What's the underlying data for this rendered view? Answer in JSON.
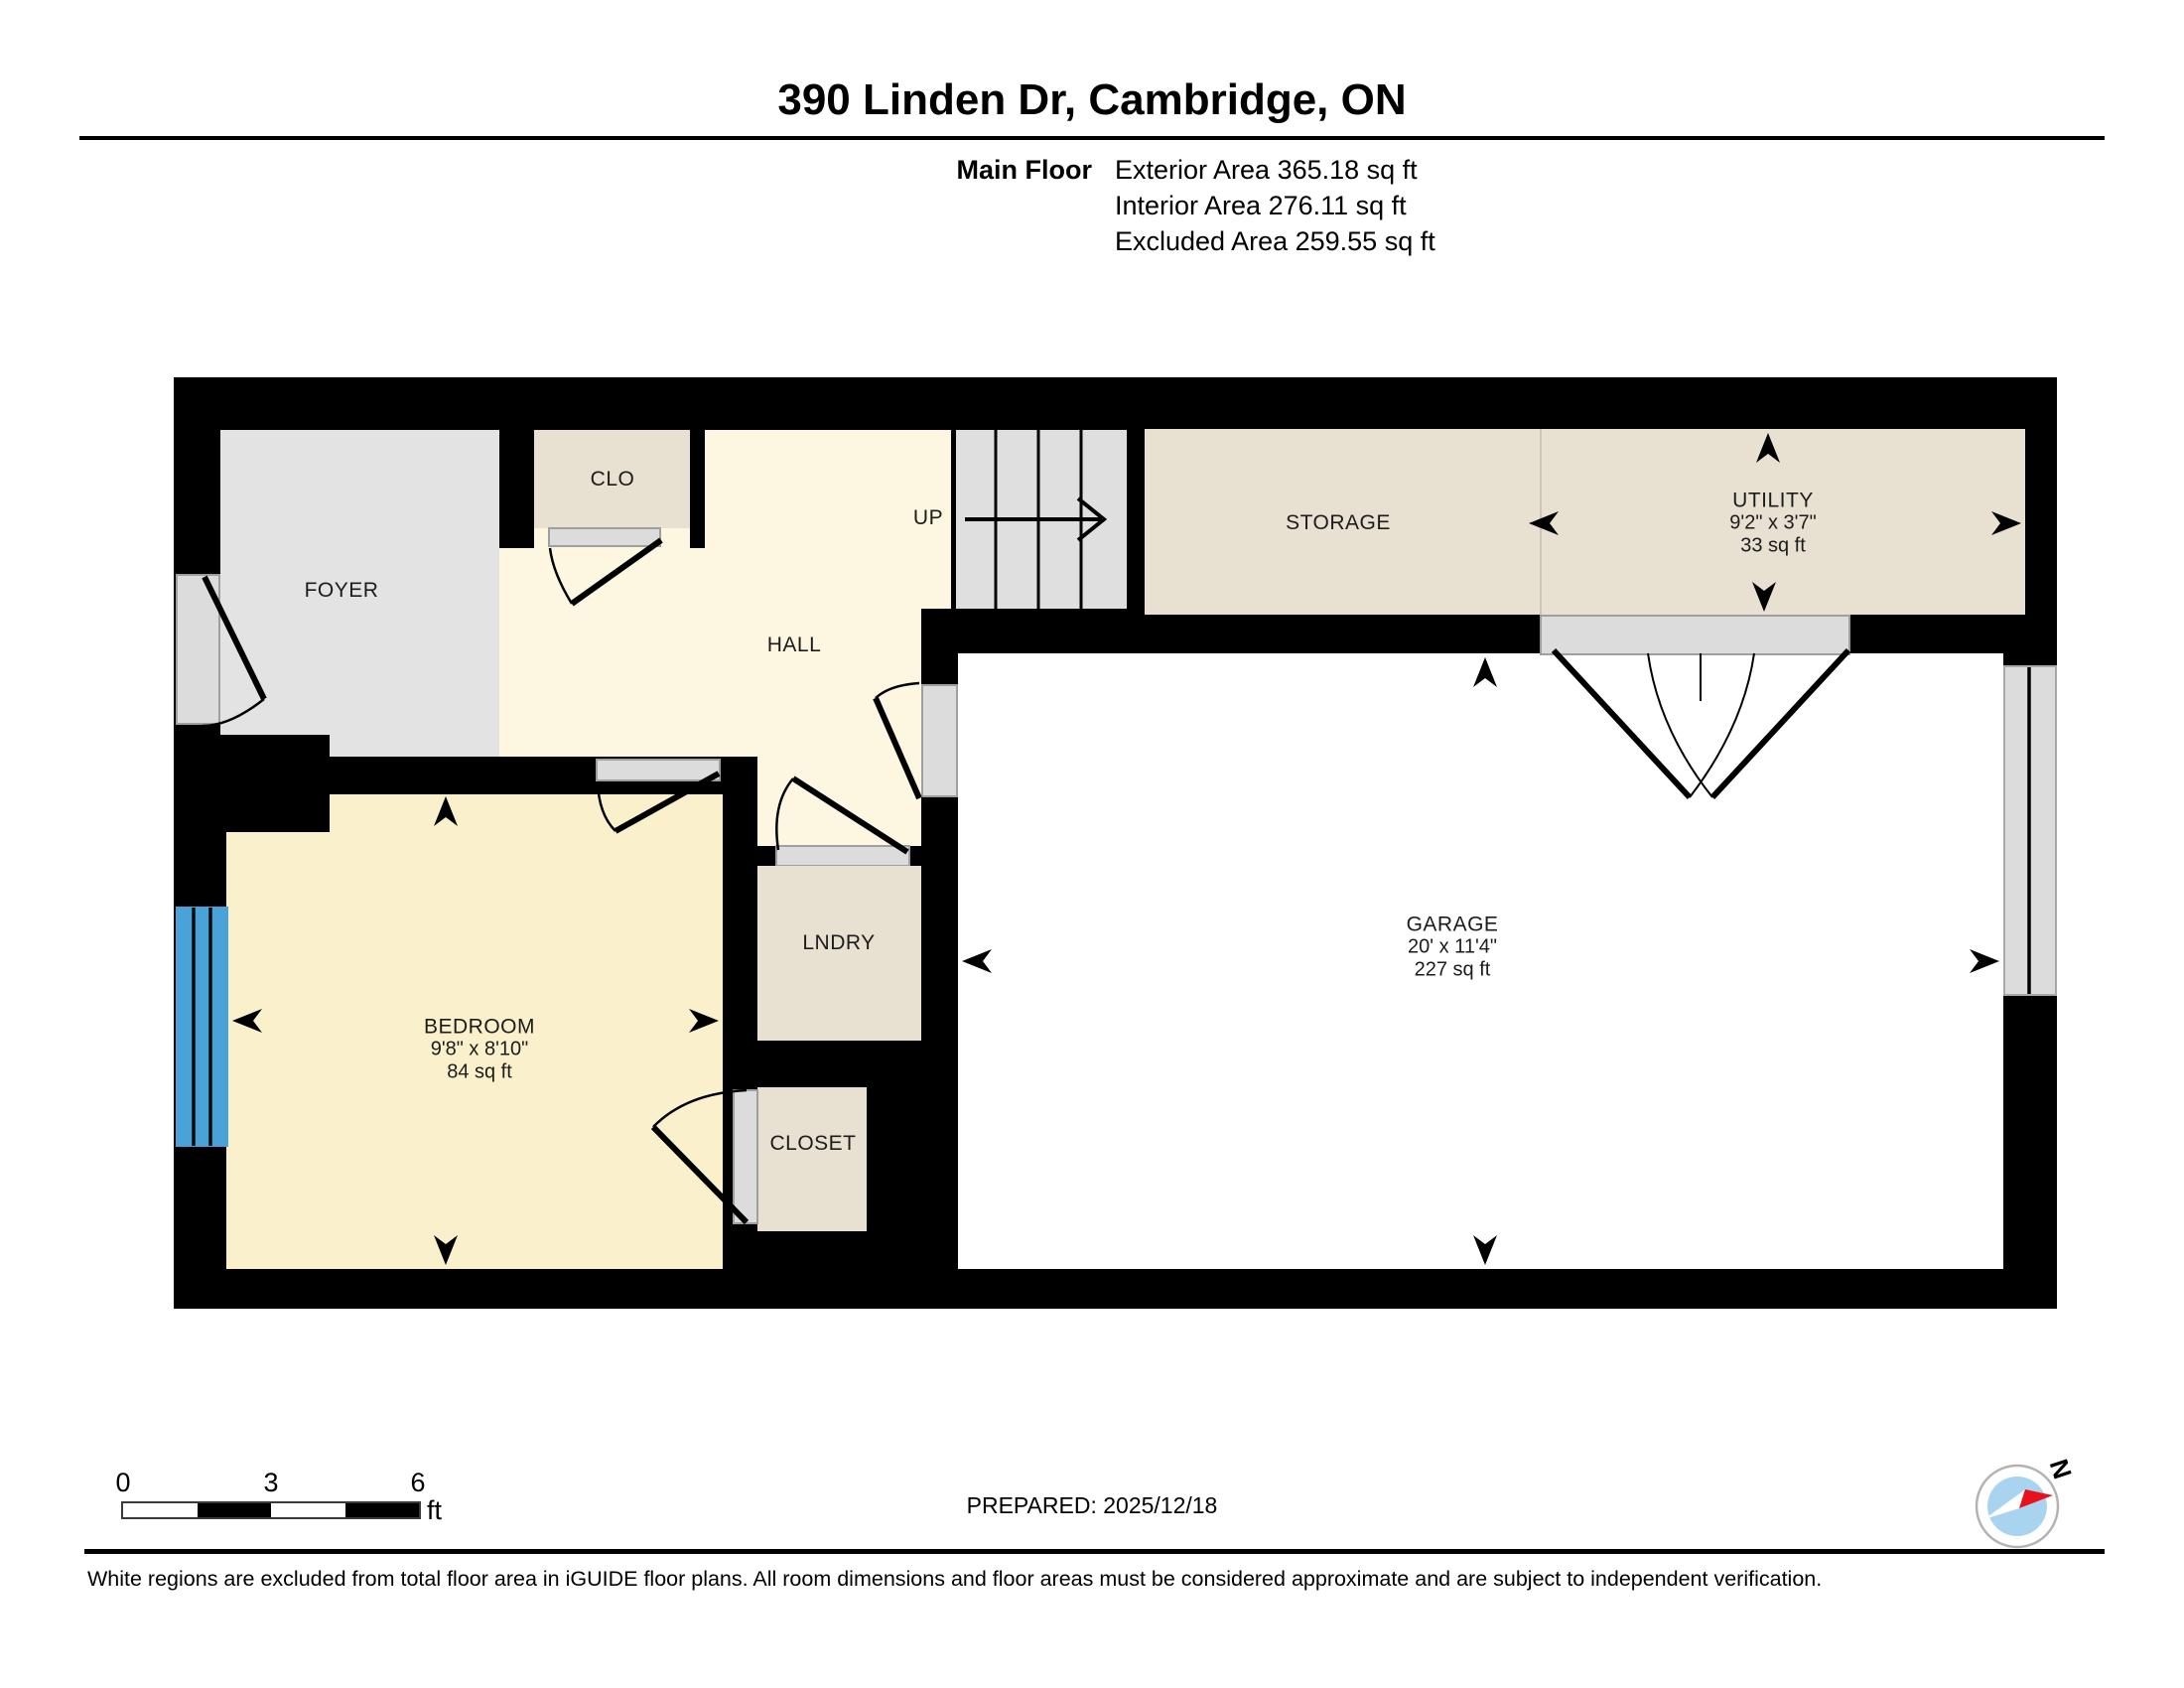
{
  "header": {
    "title": "390 Linden Dr, Cambridge, ON",
    "floor_label": "Main Floor",
    "stats": [
      "Exterior Area 365.18 sq ft",
      "Interior Area 276.11 sq ft",
      "Excluded Area 259.55 sq ft"
    ]
  },
  "rooms": {
    "foyer": {
      "label": "FOYER"
    },
    "clo": {
      "label": "CLO"
    },
    "hall": {
      "label": "HALL"
    },
    "stairs": {
      "label": "UP"
    },
    "storage": {
      "label": "STORAGE"
    },
    "utility": {
      "label": "UTILITY",
      "dimensions": "9'2\" x 3'7\"",
      "area": "33 sq ft"
    },
    "bedroom": {
      "label": "BEDROOM",
      "dimensions": "9'8\" x 8'10\"",
      "area": "84 sq ft"
    },
    "lndry": {
      "label": "LNDRY"
    },
    "closet": {
      "label": "CLOSET"
    },
    "garage": {
      "label": "GARAGE",
      "dimensions": "20' x 11'4\"",
      "area": "227 sq ft"
    }
  },
  "scale_bar": {
    "ticks": [
      "0",
      "3",
      "6"
    ],
    "unit": "ft"
  },
  "footer": {
    "prepared": "PREPARED: 2025/12/18",
    "disclaimer": "White regions are excluded from total floor area in iGUIDE floor plans. All room dimensions and floor areas must be considered approximate and are subject to independent verification.",
    "compass_label": "N"
  },
  "colors": {
    "wall": "#000000",
    "hall_fill": "#FDF6E0",
    "bedroom_fill": "#FAF0CB",
    "tan_fill": "#E8E0D1",
    "foyer_fill": "#E3E3E3",
    "window_blue": "#4AA3D8",
    "compass_red": "#E8111C",
    "compass_blue": "#A9D4EF"
  }
}
